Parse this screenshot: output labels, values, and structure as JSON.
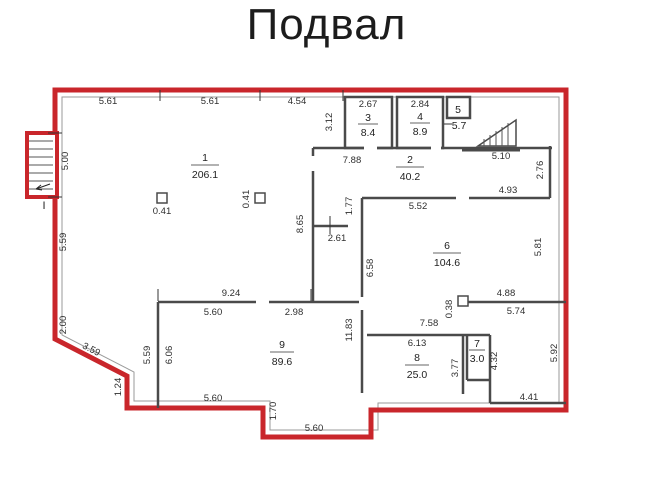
{
  "title": "Подвал",
  "entrance_marker": "I",
  "colors": {
    "outer_wall": "#c9262b",
    "interior_wall": "#4a4a4a",
    "dimension_text": "#2e2e2e",
    "title_text": "#1c1c1c"
  },
  "rooms": [
    {
      "number": "1",
      "area": "206.1"
    },
    {
      "number": "2",
      "area": "40.2"
    },
    {
      "number": "3",
      "area": "8.4"
    },
    {
      "number": "4",
      "area": "8.9"
    },
    {
      "number": "5",
      "area": "5.7"
    },
    {
      "number": "6",
      "area": "104.6"
    },
    {
      "number": "7",
      "area": "3.0"
    },
    {
      "number": "8",
      "area": "25.0"
    },
    {
      "number": "9",
      "area": "89.6"
    }
  ],
  "dims": {
    "top_1": "5.61",
    "top_2": "5.61",
    "top_3": "4.54",
    "room3_w": "2.67",
    "room3_h": "3.12",
    "room4_w": "2.84",
    "below_room3": "7.88",
    "landing_w": "5.10",
    "landing_h": "2.76",
    "below_landing": "4.93",
    "left_stair": "5.00",
    "left_upper": "5.59",
    "left_mid": "2.00",
    "left_diag": "3.59",
    "left_small": "1.24",
    "col1_size": "0.41",
    "col2_size": "0.41",
    "col3_size": "0.38",
    "wallA_h": "8.65",
    "stub": "2.61",
    "wallE_top": "1.77",
    "room6_top": "5.52",
    "room6_left": "6.58",
    "room6_right": "5.81",
    "room6_bottom": "4.88",
    "corridor_top": "5.74",
    "room8_above": "7.58",
    "room8_top": "6.13",
    "room8_right": "3.77",
    "room7_right": "4.32",
    "br_right": "5.92",
    "br_bottom": "4.41",
    "room9_above": "9.24",
    "room9_top_l": "5.60",
    "room9_top_r": "2.98",
    "room9_left_out": "5.59",
    "room9_left_in": "6.06",
    "room9_right": "11.83",
    "room9_bottom": "5.60",
    "step_h": "1.70",
    "bottom_mid": "5.60"
  }
}
